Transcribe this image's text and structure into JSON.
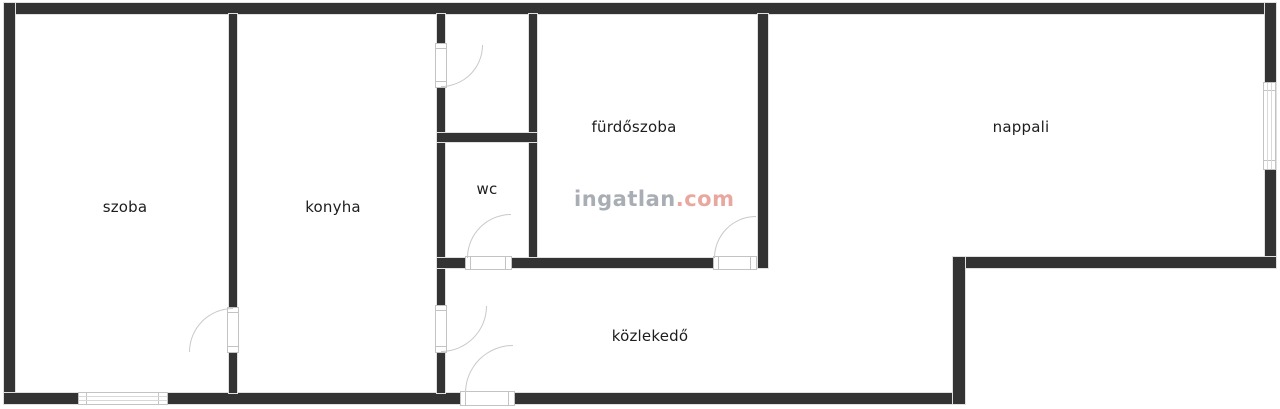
{
  "canvas": {
    "width": 1280,
    "height": 409,
    "background": "#ffffff",
    "wall_color": "#333333",
    "wall_edge_color": "#e0e0e0",
    "door_line_color": "#c3c3c3",
    "label_color": "#1d1d1d"
  },
  "watermark": {
    "brand": "ingatlan",
    "suffix": ".com",
    "brand_color": "#a9aeb5",
    "suffix_color": "#e9a89f"
  },
  "rooms": [
    {
      "name": "szoba",
      "label": "szoba",
      "cx": 125,
      "cy": 207
    },
    {
      "name": "konyha",
      "label": "konyha",
      "cx": 333,
      "cy": 207
    },
    {
      "name": "wc",
      "label": "wc",
      "cx": 487,
      "cy": 189
    },
    {
      "name": "furdoszoba",
      "label": "fürdőszoba",
      "cx": 634,
      "cy": 127
    },
    {
      "name": "nappali",
      "label": "nappali",
      "cx": 1021,
      "cy": 127
    },
    {
      "name": "kozlekedo",
      "label": "közlekedő",
      "cx": 650,
      "cy": 336
    }
  ],
  "floorplan": {
    "walls": [
      {
        "name": "outer-top",
        "x": 4,
        "y": 3,
        "w": 1272,
        "h": 11
      },
      {
        "name": "outer-left",
        "x": 4,
        "y": 3,
        "w": 11,
        "h": 401
      },
      {
        "name": "outer-bottom",
        "x": 4,
        "y": 393,
        "w": 961,
        "h": 11
      },
      {
        "name": "outer-right",
        "x": 1265,
        "y": 3,
        "w": 11,
        "h": 265
      },
      {
        "name": "nappali-bottom",
        "x": 953,
        "y": 257,
        "w": 323,
        "h": 11
      },
      {
        "name": "step-right",
        "x": 953,
        "y": 257,
        "w": 12,
        "h": 147
      },
      {
        "name": "szoba-konyha",
        "x": 229,
        "y": 14,
        "w": 8,
        "h": 379
      },
      {
        "name": "konyha-hall",
        "x": 437,
        "y": 14,
        "w": 8,
        "h": 379
      },
      {
        "name": "storage-bath",
        "x": 529,
        "y": 14,
        "w": 8,
        "h": 254
      },
      {
        "name": "storage-wc-divider",
        "x": 437,
        "y": 133,
        "w": 100,
        "h": 9
      },
      {
        "name": "wc-bath-bottom",
        "x": 437,
        "y": 258,
        "w": 331,
        "h": 10
      },
      {
        "name": "bath-nappali",
        "x": 758,
        "y": 14,
        "w": 10,
        "h": 254
      }
    ],
    "doors": [
      {
        "name": "szoba-door",
        "dir": "v",
        "panel": {
          "x": 227,
          "y": 307,
          "w": 12,
          "h": 46
        },
        "arc": {
          "cx": 233,
          "cy": 352,
          "r": 44,
          "quad": "nw"
        }
      },
      {
        "name": "storage-door",
        "dir": "v",
        "panel": {
          "x": 435,
          "y": 43,
          "w": 12,
          "h": 45
        },
        "arc": {
          "cx": 441,
          "cy": 45,
          "r": 42,
          "quad": "se"
        }
      },
      {
        "name": "konyha-hall-door",
        "dir": "v",
        "panel": {
          "x": 435,
          "y": 305,
          "w": 12,
          "h": 48
        },
        "arc": {
          "cx": 441,
          "cy": 306,
          "r": 46,
          "quad": "se"
        }
      },
      {
        "name": "wc-door",
        "dir": "h",
        "panel": {
          "x": 465,
          "y": 256,
          "w": 47,
          "h": 14
        },
        "arc": {
          "cx": 511,
          "cy": 258,
          "r": 44,
          "quad": "nw"
        }
      },
      {
        "name": "bathroom-door",
        "dir": "h",
        "panel": {
          "x": 713,
          "y": 256,
          "w": 44,
          "h": 14
        },
        "arc": {
          "cx": 756,
          "cy": 258,
          "r": 42,
          "quad": "nw"
        }
      },
      {
        "name": "entry-door",
        "dir": "h",
        "panel": {
          "x": 460,
          "y": 391,
          "w": 55,
          "h": 15
        },
        "arc": {
          "cx": 513,
          "cy": 393,
          "r": 48,
          "quad": "nw"
        }
      }
    ],
    "windows": [
      {
        "name": "szoba-window",
        "dir": "h",
        "x": 78,
        "y": 392,
        "w": 90,
        "h": 13
      },
      {
        "name": "nappali-window",
        "dir": "v",
        "x": 1263,
        "y": 82,
        "w": 13,
        "h": 88
      }
    ]
  }
}
